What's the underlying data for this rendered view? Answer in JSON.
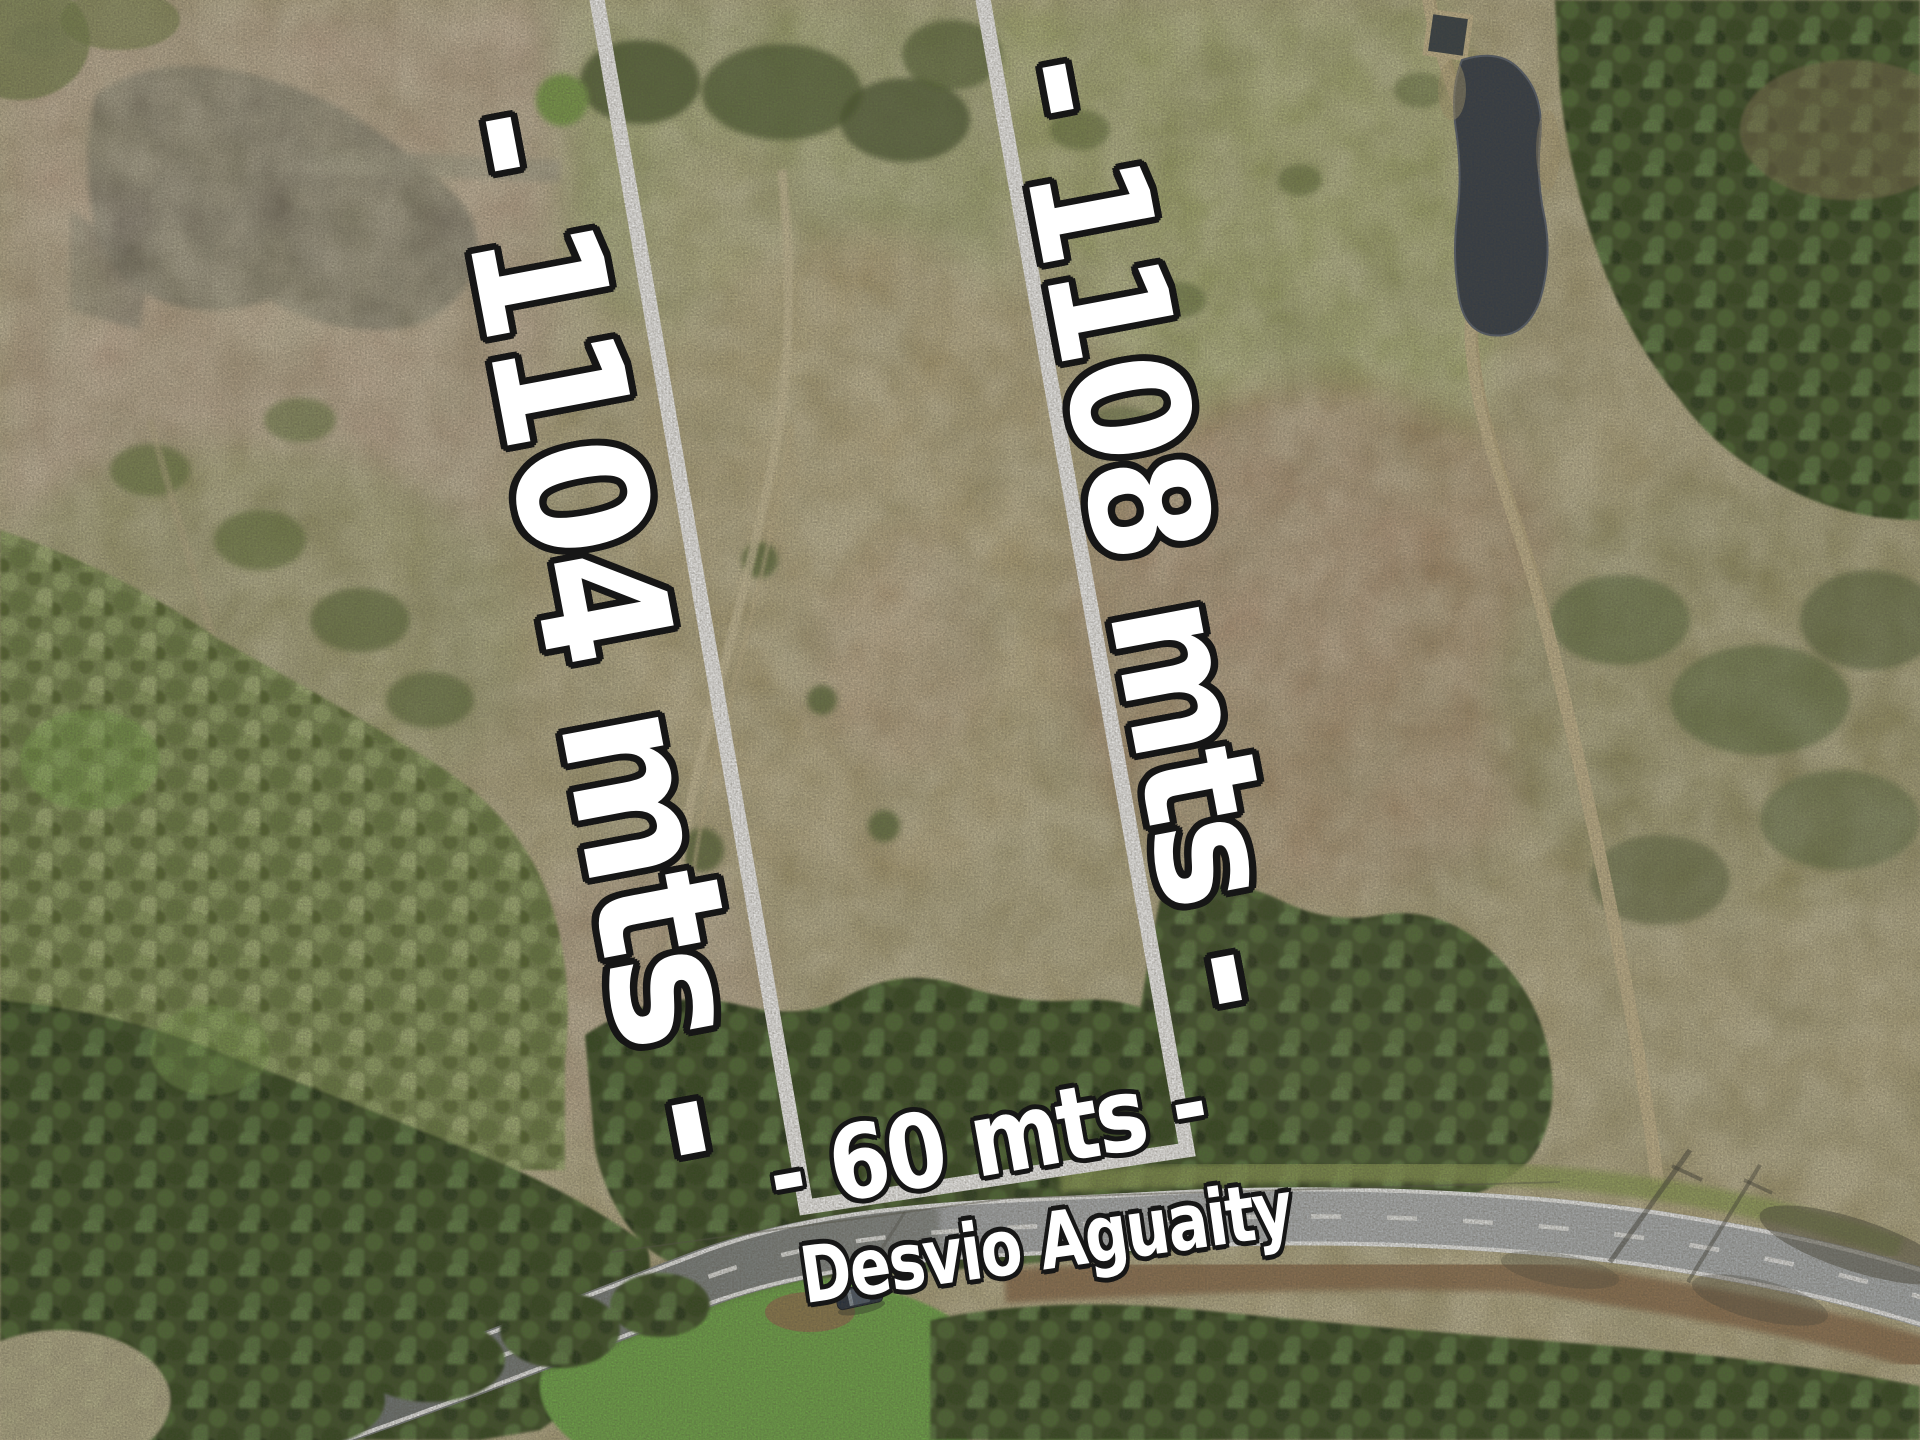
{
  "annotations": {
    "left_boundary_label": "- 1104 mts -",
    "right_boundary_label": "- 1108 mts -",
    "frontage_label": "- 60 mts -",
    "road_label": "Desvio Aguaity"
  },
  "palette": {
    "overlay_white": "#ffffff",
    "overlay_outline": "#161616",
    "boundary_white": "#ffffff",
    "road_asphalt": "#b2b6b9",
    "road_asphalt_shaded": "#80878c",
    "field_tan": "#ab9e72",
    "pasture_green": "#9da75f",
    "marsh_pink": "#bfa48d",
    "forest_green": "#44582c",
    "water_dark": "#6f695e",
    "pond_dark": "#313a46",
    "grass_bright": "#6fab48",
    "dirt_track_tan": "#cdbc93",
    "car_body": "#222c3b"
  }
}
